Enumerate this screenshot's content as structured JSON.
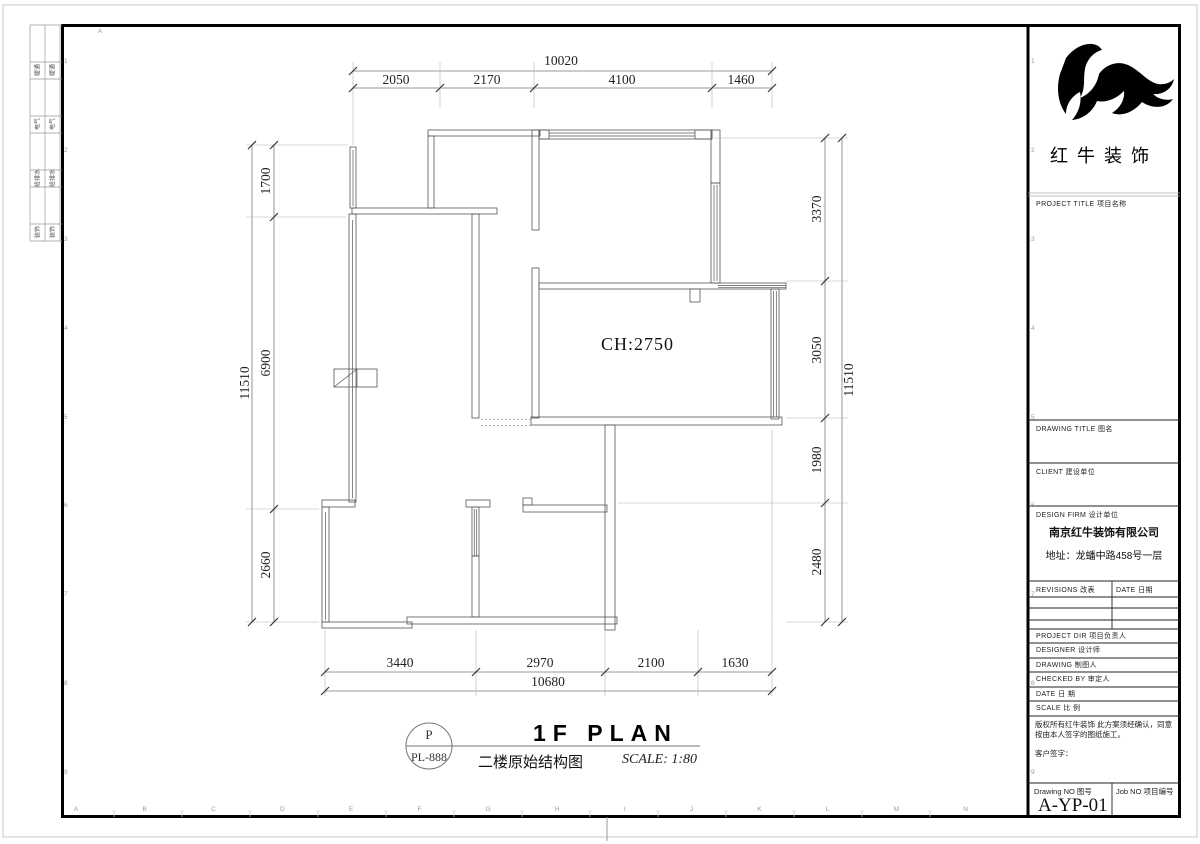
{
  "plan": {
    "ceiling_height": "CH:2750",
    "dims": {
      "top": {
        "overall": "10020",
        "segments": [
          "2050",
          "2170",
          "4100",
          "1460"
        ]
      },
      "bottom": {
        "overall": "10680",
        "segments": [
          "3440",
          "2970",
          "2100",
          "1630"
        ]
      },
      "left": {
        "overall": "11510",
        "segments": [
          "1700",
          "6900",
          "2660"
        ]
      },
      "right": {
        "overall": "11510",
        "segments": [
          "3370",
          "3050",
          "1980",
          "2480"
        ]
      }
    }
  },
  "title_bar": {
    "detail_tag_top": "P",
    "detail_tag_bottom": "PL-888",
    "title_en": "1F PLAN",
    "title_cn": "二楼原始结构图",
    "scale": "SCALE: 1:80"
  },
  "title_block": {
    "brand": "红牛装饰",
    "project_title": "PROJECT TITLE   项目名称",
    "drawing_title": "DRAWING TITLE   图名",
    "client": "CLIENT   建设单位",
    "design_firm": "DESIGN FIRM   设计单位",
    "company": "南京红牛装饰有限公司",
    "address": "地址：龙蟠中路458号一层",
    "revisions_label": "REVISIONS  改表",
    "rev_date_label": "DATE  日期",
    "rows": [
      "PROJECT DIR   项目负责人",
      "DESIGNER      设计师",
      "DRAWING       制图人",
      "CHECKED BY  审定人",
      "DATE             日  期",
      "SCALE           比  例"
    ],
    "copyright": "版权所有红牛装饰 此方案须经确认，同意按由本人签字的图纸施工。",
    "client_sign": "客户签字：",
    "drawing_no_label": "Drawing NO 图号",
    "drawing_no": "A-YP-01",
    "job_no_label": "Job NO 项目编号"
  },
  "margins": {
    "disciplines": [
      "暖通",
      "电气",
      "给排水",
      "装饰"
    ],
    "bottom_letters": [
      "A",
      "B",
      "C",
      "D",
      "E",
      "F",
      "G",
      "H",
      "I",
      "J",
      "K",
      "L",
      "M",
      "N"
    ],
    "side_numbers": [
      "1",
      "2",
      "3",
      "4",
      "5",
      "6",
      "7",
      "8",
      "9"
    ],
    "top_letter": "A"
  }
}
